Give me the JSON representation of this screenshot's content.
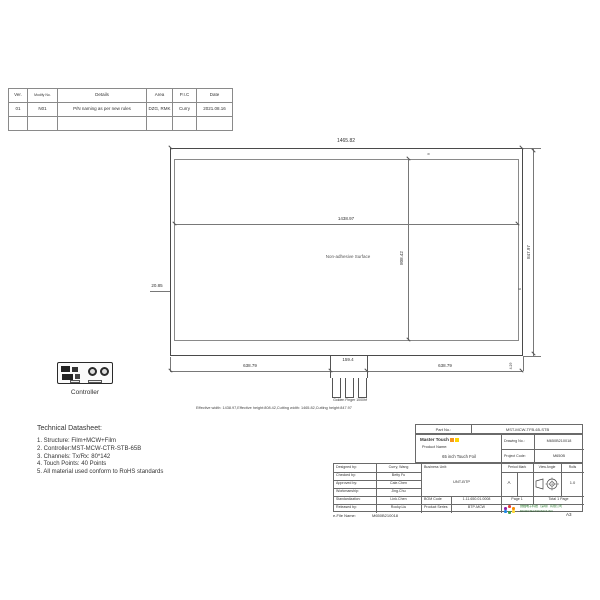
{
  "revision_table": {
    "headers": [
      "Ver.",
      "Modify No.",
      "Details",
      "Area",
      "P.I.C",
      "Date"
    ],
    "row": [
      "01",
      "N01",
      "P/N naming as per new rules",
      "DZG, RMK",
      "Curry",
      "2021.08.16"
    ]
  },
  "drawing": {
    "dim_cutting_width": "1465.82",
    "dim_effective_width": "1438.97",
    "dim_effective_height": "808.42",
    "dim_cutting_height": "847.97",
    "dim_left_margin": "20.85",
    "dim_top_margin": "9",
    "dim_right_margin": "6",
    "dim_bottom_left": "638.79",
    "dim_tail_width": "159.4",
    "dim_bottom_right": "638.79",
    "dim_corner": "4.29",
    "surface_label": "Non-adhesive Surface",
    "golden_finger_label": "Golden Finger 1000hf",
    "note": "Effective width: 1438.97,Effective height:808.42,Cutting width: 1465.82,Cutting height:847.97",
    "controller_label": "Controller"
  },
  "datasheet": {
    "title": "Technical Datasheet:",
    "items": [
      "1. Structure: Film+MCW+Film",
      "2. Controller:MST-MCW-CTR-STB-65B",
      "3. Channels: Tx/Rx: 80*142",
      "4. Touch Points: 40 Points",
      "5. All material used conform to RoHS standards"
    ]
  },
  "title_block": {
    "part_no_label": "Part No.:",
    "part_no": "MST-MCW-TFB-65-STB",
    "brand": "Master Touch",
    "product_name_label": "Product Name:",
    "product_name": "65 inch Touch Foil",
    "drawing_no_label": "Drawing No.:",
    "drawing_no": "M650B210018",
    "project_code_label": "Project Code:",
    "project_code": "M650B",
    "left_rows": [
      {
        "label": "Designed by:",
        "value": "Curry, Wang"
      },
      {
        "label": "Checked by:",
        "value": "Betty Fu"
      },
      {
        "label": "Approved by:",
        "value": "Cale.Chen"
      },
      {
        "label": "Workmanship:",
        "value": "Jing.Chu"
      },
      {
        "label": "Standardization:",
        "value": "Link.Chen"
      },
      {
        "label": "Released by:",
        "value": "Rocky.Liu"
      }
    ],
    "business_unit_label": "Business Unit:",
    "business_unit": "UNT-BTP",
    "bom_code_label": "BOM Code",
    "bom_code": "1.11.650.01.0008",
    "product_series_label": "Product Series",
    "product_series": "BTP-MCW",
    "period_mark_label": "Period Mark",
    "period_mark": "A",
    "view_angle_label": "View Angle",
    "rolls_label": "Rolls",
    "rolls": "1.0",
    "page": "Page 1",
    "total": "Total 1 Page",
    "company_cn": "微触电子科技（深圳）有限公司",
    "company_en": "MICROTECTRONICS INC"
  },
  "footer": {
    "efile_label": "e-File Name:",
    "efile_value": "M650B210018",
    "sheet_size": "A3"
  },
  "icons": {
    "view_angle_icon": "third-angle-projection",
    "brand_icon": "master-touch-logo",
    "company_icon": "color-dots-logo"
  },
  "colors": {
    "brand_orange": "#f7941d",
    "brand_yellow": "#ffd400",
    "company_green": "#2e7d32"
  }
}
